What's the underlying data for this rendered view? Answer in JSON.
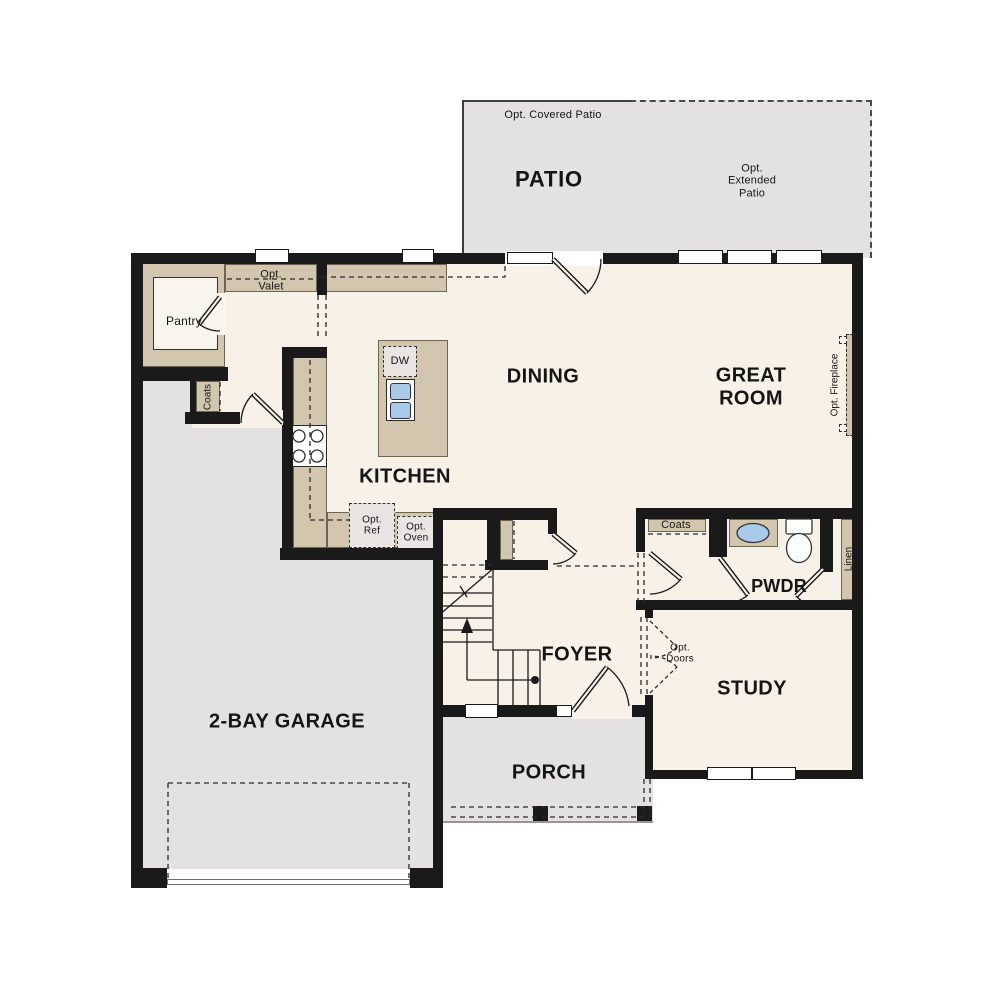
{
  "plan": {
    "outdoor": {
      "patio": "PATIO",
      "covered_note": "Opt. Covered Patio",
      "extended_note": "Opt.\nExtended\nPatio",
      "porch": "PORCH"
    },
    "rooms": {
      "dining": "DINING",
      "great_room": "GREAT\nROOM",
      "kitchen": "KITCHEN",
      "foyer": "FOYER",
      "study": "STUDY",
      "pwdr": "PWDR",
      "garage": "2-BAY GARAGE",
      "pantry": "Pantry"
    },
    "closets": {
      "coats_mud": "Coats",
      "coats_hall": "Coats",
      "linen": "Linen"
    },
    "options": {
      "valet": "Opt.\nValet",
      "ref": "Opt.\nRef",
      "oven": "Opt.\nOven",
      "fireplace": "Opt. Fireplace",
      "doors": "Opt.\nDoors"
    },
    "appliances": {
      "dishwasher": "DW"
    }
  },
  "colors": {
    "floor": "#f7f1e7",
    "outdoor": "#e3e1e1",
    "wall": "#1a1a1a",
    "tan": "#d3c6ae",
    "sink_blue": "#a9c9e8"
  }
}
